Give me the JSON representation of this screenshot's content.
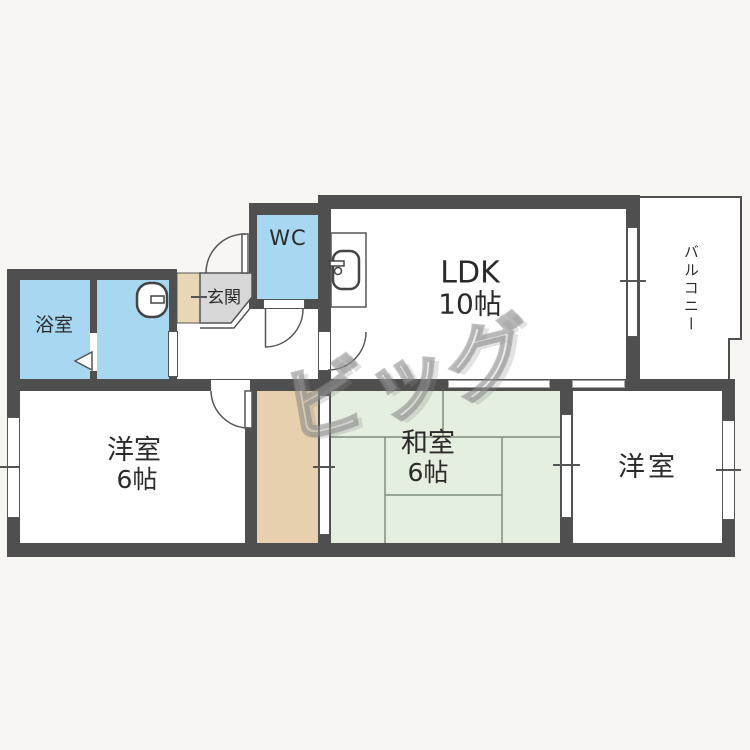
{
  "floorplan": {
    "watermark": "ビッグ",
    "rooms": {
      "ldk": {
        "label": "LDK",
        "size": "10帖"
      },
      "balcony": {
        "label": "バルコニー"
      },
      "wc": {
        "label": "WC"
      },
      "entrance": {
        "label": "玄関"
      },
      "bathroom": {
        "label": "浴室"
      },
      "western_left": {
        "label": "洋室",
        "size": "6帖"
      },
      "japanese_room": {
        "label": "和室",
        "size": "6帖"
      },
      "western_right": {
        "label": "洋室"
      }
    },
    "colors": {
      "water_rooms": "#a8d7f1",
      "tatami": "#e5efdf",
      "closet": "#e7d0ae",
      "entrance_floor": "#d8d8d8",
      "entrance_step": "#e9d6b6",
      "wall": "#4f4f4f",
      "background": "#f8f6f2"
    }
  }
}
